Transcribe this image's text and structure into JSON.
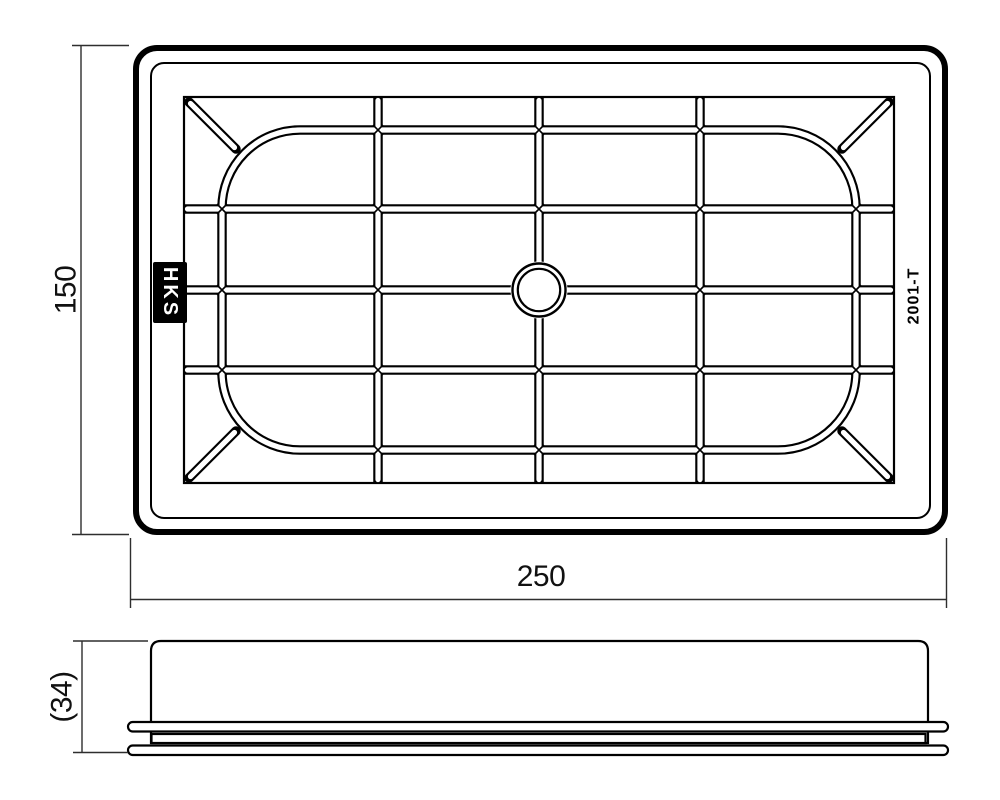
{
  "drawing": {
    "description": "Air filter technical drawing with top view and side view",
    "colors": {
      "background": "#ffffff",
      "part_line": "#000000",
      "dimension_line": "#2e2e2e",
      "text": "#111111",
      "logo_background": "#000000",
      "logo_text_color": "#ffffff"
    },
    "branding": {
      "logo_text": "HKS",
      "part_number": "2001-T"
    },
    "dimensions": {
      "width_label": "250",
      "height_label": "150",
      "depth_label": "(34)"
    },
    "top_view": {
      "grid_columns": 4,
      "grid_rows": 4,
      "corner_braces": 4,
      "has_center_hole": true
    },
    "side_view": {
      "flange_layers": 3
    }
  }
}
